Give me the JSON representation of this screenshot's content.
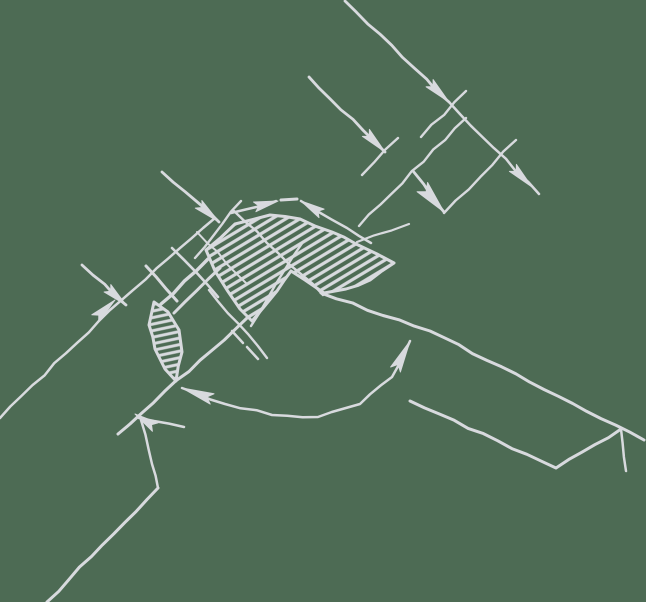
{
  "canvas": {
    "width": 646,
    "height": 602,
    "background_color": "#4d6b54",
    "line_color": "#d8dade",
    "description": "Technical drawing of a welded joint cross-section: hatched weld bead with V notch, hatched root lens, dimension lines with arrowheads, extension ticks, angle arc, plate edges. No text labels present."
  },
  "diagram": {
    "blobs": [
      {
        "name": "weld-bead-hatched",
        "outline": [
          [
            206,
            250
          ],
          [
            235,
            224
          ],
          [
            270,
            215
          ],
          [
            300,
            219
          ],
          [
            332,
            232
          ],
          [
            356,
            244
          ],
          [
            377,
            254
          ],
          [
            394,
            263
          ],
          [
            370,
            280
          ],
          [
            346,
            289
          ],
          [
            324,
            293
          ],
          [
            305,
            280
          ],
          [
            291,
            271
          ],
          [
            277,
            291
          ],
          [
            263,
            308
          ],
          [
            252,
            321
          ],
          [
            240,
            309
          ],
          [
            227,
            290
          ],
          [
            215,
            271
          ]
        ],
        "hatch_angle": -31,
        "hatch_gap": 7.2,
        "hatch_width": 3.2,
        "outline_width": 3
      },
      {
        "name": "root-lens-hatched",
        "outline": [
          [
            154,
            302
          ],
          [
            168,
            312
          ],
          [
            179,
            330
          ],
          [
            182,
            352
          ],
          [
            176,
            381
          ],
          [
            165,
            369
          ],
          [
            155,
            349
          ],
          [
            149,
            325
          ]
        ],
        "hatch_angle": -12,
        "hatch_gap": 6.4,
        "hatch_width": 3.0,
        "outline_width": 3
      }
    ],
    "lines": [
      {
        "name": "dim-line-upper-1",
        "pts": [
          [
            345,
            1
          ],
          [
            449,
            102
          ]
        ],
        "w": 2.8
      },
      {
        "name": "ext-tick-upper-1",
        "pts": [
          [
            421,
            137
          ],
          [
            466,
            91
          ]
        ],
        "w": 2.4
      },
      {
        "name": "dim-line-upper-2",
        "pts": [
          [
            309,
            77
          ],
          [
            385,
            152
          ]
        ],
        "w": 2.8
      },
      {
        "name": "ext-tick-upper-2",
        "pts": [
          [
            362,
            175
          ],
          [
            398,
            138
          ]
        ],
        "w": 2.4
      },
      {
        "name": "ext-line-upper-long",
        "pts": [
          [
            359,
            226
          ],
          [
            466,
            118
          ]
        ],
        "w": 2.4
      },
      {
        "name": "dim-line-upper-3",
        "pts": [
          [
            413,
            171
          ],
          [
            444,
            212
          ]
        ],
        "w": 2.8
      },
      {
        "name": "ext-line-upper-right",
        "pts": [
          [
            444,
            213
          ],
          [
            516,
            140
          ]
        ],
        "w": 2.4
      },
      {
        "name": "dim-line-upper-4",
        "pts": [
          [
            449,
            102
          ],
          [
            539,
            194
          ]
        ],
        "w": 2.5
      },
      {
        "name": "apex-tangent-left",
        "pts": [
          [
            231,
            213
          ],
          [
            276,
            201
          ]
        ],
        "w": 2.5
      },
      {
        "name": "apex-gap-bar",
        "pts": [
          [
            281,
            200
          ],
          [
            297,
            199
          ]
        ],
        "w": 3.0
      },
      {
        "name": "apex-tangent-right",
        "pts": [
          [
            301,
            201
          ],
          [
            347,
            228
          ],
          [
            371,
            243
          ]
        ],
        "w": 2.5
      },
      {
        "name": "apex-ext-tick-right",
        "pts": [
          [
            357,
            242
          ],
          [
            409,
            224
          ]
        ],
        "w": 2.2
      },
      {
        "name": "ext-line-left-long",
        "pts": [
          [
            0,
            418
          ],
          [
            110,
            310
          ],
          [
            215,
            218
          ]
        ],
        "w": 2.5
      },
      {
        "name": "dim-line-left-1",
        "pts": [
          [
            162,
            172
          ],
          [
            219,
            222
          ]
        ],
        "w": 2.8
      },
      {
        "name": "ext-tick-left-1",
        "pts": [
          [
            195,
            258
          ],
          [
            241,
            201
          ]
        ],
        "w": 2.4
      },
      {
        "name": "dim-line-left-2",
        "pts": [
          [
            82,
            265
          ],
          [
            126,
            305
          ]
        ],
        "w": 2.8
      },
      {
        "name": "step-line-diag-1",
        "pts": [
          [
            161,
            304
          ],
          [
            208,
            259
          ]
        ],
        "w": 3.4
      },
      {
        "name": "step-line-diag-2",
        "pts": [
          [
            174,
            313
          ],
          [
            220,
            268
          ]
        ],
        "w": 3.0
      },
      {
        "name": "step-tick-1",
        "pts": [
          [
            146,
            266
          ],
          [
            177,
            301
          ]
        ],
        "w": 3.0
      },
      {
        "name": "step-tick-2",
        "pts": [
          [
            172,
            248
          ],
          [
            218,
            297
          ]
        ],
        "w": 2.6
      },
      {
        "name": "step-tick-3",
        "pts": [
          [
            197,
            232
          ],
          [
            247,
            284
          ]
        ],
        "w": 2.0
      },
      {
        "name": "groove-face-left",
        "pts": [
          [
            251,
            326
          ],
          [
            303,
            242
          ]
        ],
        "w": 2.4
      },
      {
        "name": "groove-face-right",
        "pts": [
          [
            234,
            211
          ],
          [
            323,
            295
          ]
        ],
        "w": 2.4
      },
      {
        "name": "ext-below-bead",
        "pts": [
          [
            209,
            290
          ],
          [
            267,
            358
          ]
        ],
        "w": 2.4
      },
      {
        "name": "root-dash-1",
        "pts": [
          [
            232,
            331
          ],
          [
            243,
            343
          ]
        ],
        "w": 2.5
      },
      {
        "name": "root-dash-2",
        "pts": [
          [
            247,
            347
          ],
          [
            258,
            359
          ]
        ],
        "w": 2.5
      },
      {
        "name": "plate-edge-left",
        "pts": [
          [
            118,
            434
          ],
          [
            247,
            318
          ]
        ],
        "w": 3.0
      },
      {
        "name": "plate-edge-right",
        "pts": [
          [
            321,
            293
          ],
          [
            430,
            331
          ],
          [
            644,
            440
          ]
        ],
        "w": 3.0
      },
      {
        "name": "leader-tail",
        "pts": [
          [
            139,
            418
          ],
          [
            184,
            427
          ]
        ],
        "w": 2.5
      },
      {
        "name": "leader-stem",
        "pts": [
          [
            141,
            420
          ],
          [
            152,
            464
          ],
          [
            158,
            488
          ]
        ],
        "w": 2.5
      },
      {
        "name": "lower-left-edge",
        "pts": [
          [
            158,
            488
          ],
          [
            47,
            602
          ]
        ],
        "w": 3.0
      },
      {
        "name": "lower-right-flange",
        "pts": [
          [
            410,
            401
          ],
          [
            556,
            468
          ],
          [
            621,
            429
          ]
        ],
        "w": 3.0
      },
      {
        "name": "lower-right-drop",
        "pts": [
          [
            621,
            429
          ],
          [
            626,
            471
          ]
        ],
        "w": 2.5
      },
      {
        "name": "angle-dim-arc",
        "pts": [
          [
            182,
            388
          ],
          [
            225,
            404
          ],
          [
            272,
            415
          ],
          [
            318,
            417
          ],
          [
            360,
            404
          ],
          [
            392,
            377
          ],
          [
            410,
            341
          ]
        ],
        "w": 2.5
      }
    ],
    "arrows": [
      {
        "name": "arrowhead-upper-1",
        "tip": [
          449,
          102
        ],
        "angle": 44,
        "len": 27,
        "hw": 5
      },
      {
        "name": "arrowhead-upper-2",
        "tip": [
          385,
          152
        ],
        "angle": 45,
        "len": 27,
        "hw": 5
      },
      {
        "name": "arrowhead-upper-3",
        "tip": [
          444,
          212
        ],
        "angle": 49,
        "len": 33,
        "hw": 7
      },
      {
        "name": "arrowhead-upper-4",
        "tip": [
          532,
          187
        ],
        "angle": 45,
        "len": 27,
        "hw": 5
      },
      {
        "name": "arrowhead-apex-left",
        "tip": [
          278,
          201
        ],
        "angle": -14,
        "len": 24,
        "hw": 5
      },
      {
        "name": "arrowhead-apex-right",
        "tip": [
          301,
          201
        ],
        "angle": -149,
        "len": 24,
        "hw": 5
      },
      {
        "name": "arrowhead-ext-left",
        "tip": [
          115,
          300
        ],
        "angle": -43,
        "len": 27,
        "hw": 5
      },
      {
        "name": "arrowhead-left-1",
        "tip": [
          219,
          222
        ],
        "angle": 41,
        "len": 27,
        "hw": 5
      },
      {
        "name": "arrowhead-left-2",
        "tip": [
          126,
          305
        ],
        "angle": 42,
        "len": 25,
        "hw": 5
      },
      {
        "name": "arrowhead-leader",
        "tip": [
          135,
          414
        ],
        "angle": -147,
        "len": 24,
        "hw": 5
      },
      {
        "name": "arrowhead-arc-left",
        "tip": [
          182,
          388
        ],
        "angle": -160,
        "len": 32,
        "hw": 5.5
      },
      {
        "name": "arrowhead-arc-right",
        "tip": [
          410,
          341
        ],
        "angle": -63,
        "len": 32,
        "hw": 5.5
      }
    ]
  }
}
